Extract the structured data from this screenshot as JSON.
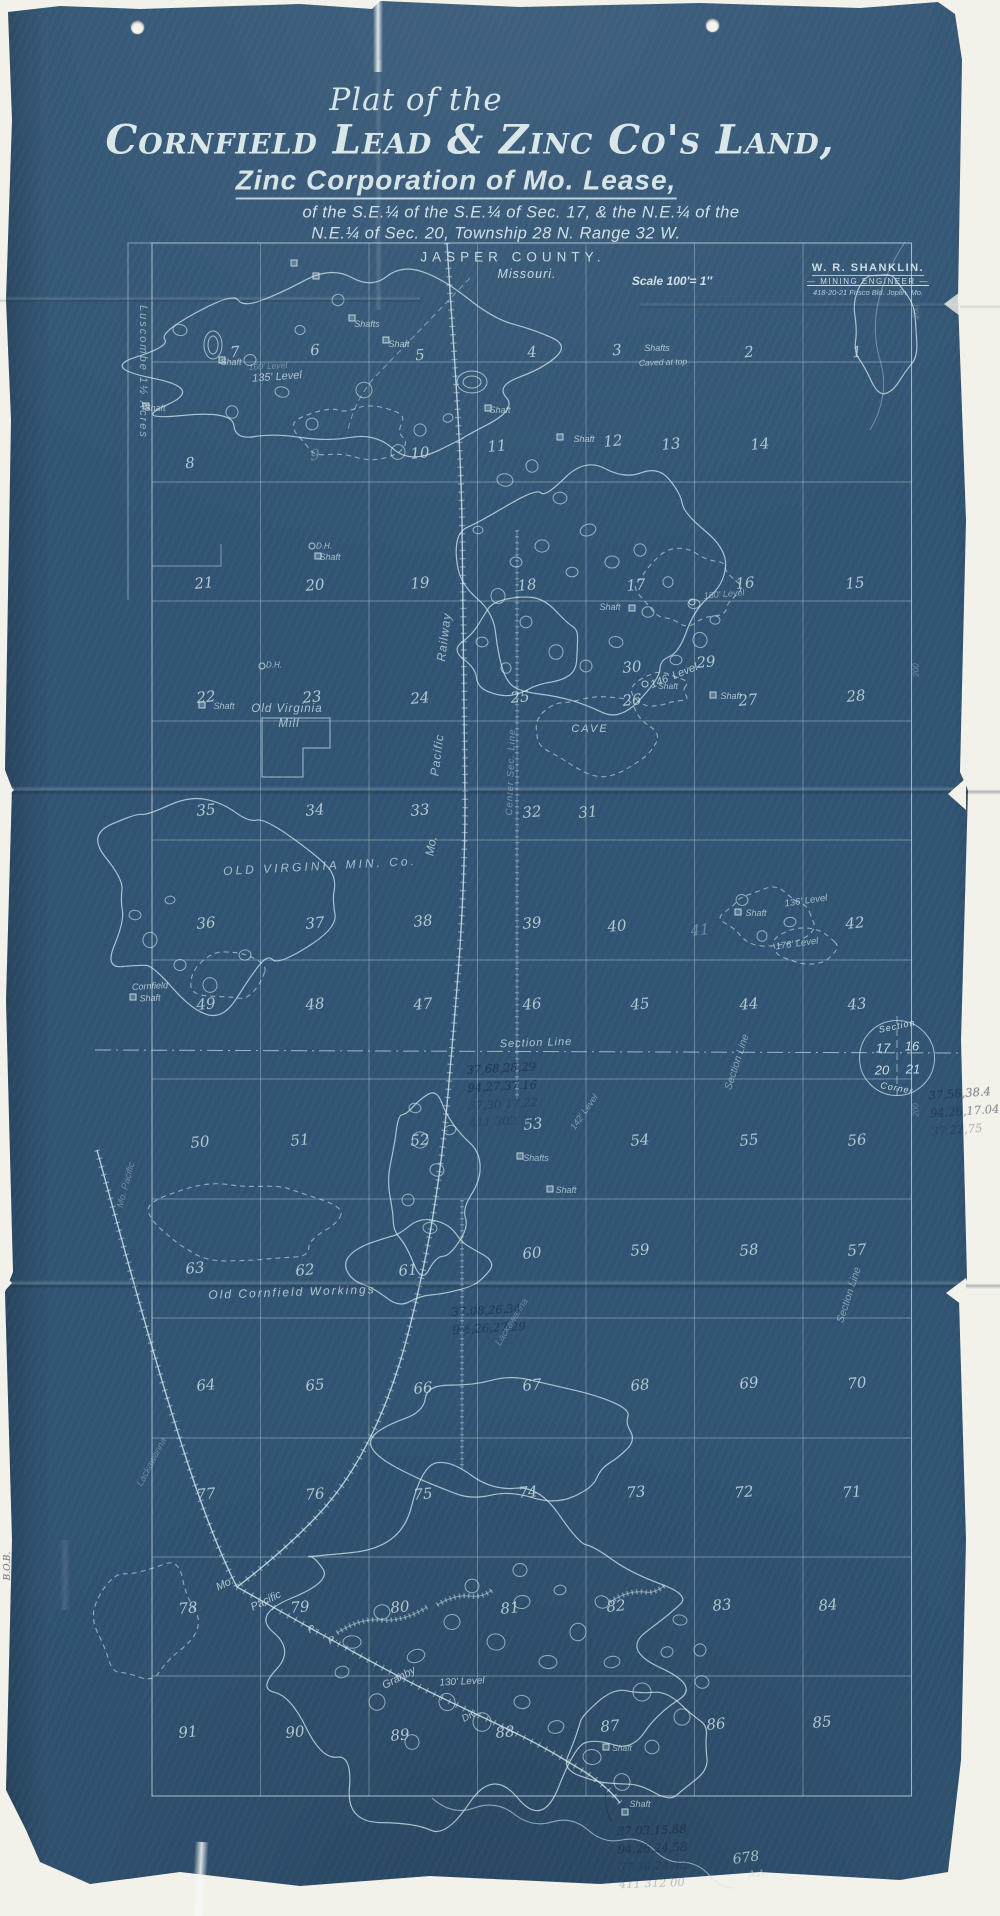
{
  "page": {
    "background": "#f2f1ea",
    "blueprint_color": "#315474",
    "ink_color": "#cfe0e4",
    "pencil_color": "#1d2a42"
  },
  "title": {
    "prefix": "Plat of the",
    "main": "Cornfield Lead & Zinc Co's Land,",
    "sub": "Zinc Corporation of Mo. Lease,",
    "desc1": "of the S.E.¼ of the S.E.¼ of Sec. 17, & the N.E.¼ of the",
    "desc2": "N.E.¼ of Sec. 20, Township 28 N. Range 32 W.",
    "county": "JASPER COUNTY.",
    "state": "Missouri.",
    "scale": "Scale 100'= 1″"
  },
  "stamp": {
    "name": "W. R. SHANKLIN.",
    "role": "— MINING ENGINEER —",
    "address": "418-20-21 Frisco Bld.   Joplin, Mo."
  },
  "section_corner": {
    "arc_top": "Section",
    "nw": "17",
    "ne": "16",
    "sw": "20",
    "se": "21",
    "arc_bottom": "Corner"
  },
  "corner_annotations": {
    "sheet_number": "678",
    "initials": "A.A.",
    "spine_mark": "B.O.B."
  },
  "map": {
    "plots": [
      {
        "n": "1",
        "x": 857,
        "y": 352
      },
      {
        "n": "2",
        "x": 749,
        "y": 352
      },
      {
        "n": "3",
        "x": 617,
        "y": 350
      },
      {
        "n": "4",
        "x": 532,
        "y": 352
      },
      {
        "n": "5",
        "x": 420,
        "y": 355
      },
      {
        "n": "6",
        "x": 315,
        "y": 350
      },
      {
        "n": "7",
        "x": 235,
        "y": 352
      },
      {
        "n": "8",
        "x": 190,
        "y": 463
      },
      {
        "n": "9",
        "x": 315,
        "y": 455,
        "f": 1
      },
      {
        "n": "10",
        "x": 420,
        "y": 453
      },
      {
        "n": "11",
        "x": 497,
        "y": 446
      },
      {
        "n": "12",
        "x": 613,
        "y": 441
      },
      {
        "n": "13",
        "x": 671,
        "y": 444
      },
      {
        "n": "14",
        "x": 760,
        "y": 444
      },
      {
        "n": "15",
        "x": 855,
        "y": 583
      },
      {
        "n": "16",
        "x": 745,
        "y": 583
      },
      {
        "n": "17",
        "x": 636,
        "y": 585
      },
      {
        "n": "18",
        "x": 527,
        "y": 585
      },
      {
        "n": "19",
        "x": 420,
        "y": 583
      },
      {
        "n": "20",
        "x": 315,
        "y": 585
      },
      {
        "n": "21",
        "x": 204,
        "y": 583
      },
      {
        "n": "22",
        "x": 206,
        "y": 697
      },
      {
        "n": "23",
        "x": 312,
        "y": 697
      },
      {
        "n": "24",
        "x": 420,
        "y": 698
      },
      {
        "n": "25",
        "x": 520,
        "y": 697
      },
      {
        "n": "26",
        "x": 632,
        "y": 700
      },
      {
        "n": "27",
        "x": 748,
        "y": 700
      },
      {
        "n": "28",
        "x": 856,
        "y": 696
      },
      {
        "n": "29",
        "x": 706,
        "y": 662
      },
      {
        "n": "30",
        "x": 632,
        "y": 667
      },
      {
        "n": "31",
        "x": 588,
        "y": 812
      },
      {
        "n": "32",
        "x": 532,
        "y": 812
      },
      {
        "n": "33",
        "x": 420,
        "y": 810
      },
      {
        "n": "34",
        "x": 315,
        "y": 810
      },
      {
        "n": "35",
        "x": 206,
        "y": 810
      },
      {
        "n": "36",
        "x": 206,
        "y": 923
      },
      {
        "n": "37",
        "x": 315,
        "y": 923
      },
      {
        "n": "38",
        "x": 423,
        "y": 921
      },
      {
        "n": "39",
        "x": 532,
        "y": 923
      },
      {
        "n": "40",
        "x": 617,
        "y": 926
      },
      {
        "n": "41",
        "x": 700,
        "y": 930,
        "f": 1
      },
      {
        "n": "42",
        "x": 855,
        "y": 923
      },
      {
        "n": "43",
        "x": 857,
        "y": 1004
      },
      {
        "n": "44",
        "x": 749,
        "y": 1004
      },
      {
        "n": "45",
        "x": 640,
        "y": 1004
      },
      {
        "n": "46",
        "x": 532,
        "y": 1004
      },
      {
        "n": "47",
        "x": 423,
        "y": 1004
      },
      {
        "n": "48",
        "x": 315,
        "y": 1004
      },
      {
        "n": "49",
        "x": 206,
        "y": 1004
      },
      {
        "n": "50",
        "x": 200,
        "y": 1142
      },
      {
        "n": "51",
        "x": 300,
        "y": 1140
      },
      {
        "n": "52",
        "x": 420,
        "y": 1140
      },
      {
        "n": "53",
        "x": 533,
        "y": 1124
      },
      {
        "n": "54",
        "x": 640,
        "y": 1140
      },
      {
        "n": "55",
        "x": 749,
        "y": 1140
      },
      {
        "n": "56",
        "x": 857,
        "y": 1140
      },
      {
        "n": "57",
        "x": 857,
        "y": 1250
      },
      {
        "n": "58",
        "x": 749,
        "y": 1250
      },
      {
        "n": "59",
        "x": 640,
        "y": 1250
      },
      {
        "n": "60",
        "x": 532,
        "y": 1253
      },
      {
        "n": "61",
        "x": 408,
        "y": 1270
      },
      {
        "n": "62",
        "x": 305,
        "y": 1270
      },
      {
        "n": "63",
        "x": 195,
        "y": 1268
      },
      {
        "n": "64",
        "x": 206,
        "y": 1385
      },
      {
        "n": "65",
        "x": 315,
        "y": 1385
      },
      {
        "n": "66",
        "x": 423,
        "y": 1388
      },
      {
        "n": "67",
        "x": 532,
        "y": 1385
      },
      {
        "n": "68",
        "x": 640,
        "y": 1385
      },
      {
        "n": "69",
        "x": 749,
        "y": 1383
      },
      {
        "n": "70",
        "x": 857,
        "y": 1383
      },
      {
        "n": "71",
        "x": 852,
        "y": 1492
      },
      {
        "n": "72",
        "x": 744,
        "y": 1492
      },
      {
        "n": "73",
        "x": 636,
        "y": 1492
      },
      {
        "n": "74",
        "x": 528,
        "y": 1492
      },
      {
        "n": "75",
        "x": 423,
        "y": 1494
      },
      {
        "n": "76",
        "x": 315,
        "y": 1494
      },
      {
        "n": "77",
        "x": 206,
        "y": 1494
      },
      {
        "n": "78",
        "x": 188,
        "y": 1608
      },
      {
        "n": "79",
        "x": 300,
        "y": 1607
      },
      {
        "n": "80",
        "x": 400,
        "y": 1607
      },
      {
        "n": "81",
        "x": 510,
        "y": 1608
      },
      {
        "n": "82",
        "x": 616,
        "y": 1606
      },
      {
        "n": "83",
        "x": 722,
        "y": 1605
      },
      {
        "n": "84",
        "x": 828,
        "y": 1605
      },
      {
        "n": "85",
        "x": 822,
        "y": 1722
      },
      {
        "n": "86",
        "x": 716,
        "y": 1724
      },
      {
        "n": "87",
        "x": 610,
        "y": 1726
      },
      {
        "n": "88",
        "x": 505,
        "y": 1732
      },
      {
        "n": "89",
        "x": 400,
        "y": 1735
      },
      {
        "n": "90",
        "x": 295,
        "y": 1732
      },
      {
        "n": "91",
        "x": 188,
        "y": 1732
      }
    ],
    "labels": [
      {
        "t": "Luscombe  1½ Acres",
        "x": 143,
        "y": 372,
        "r": 90,
        "s": 11,
        "o": 0.7,
        "ls": 2
      },
      {
        "t": "135' Level",
        "x": 277,
        "y": 377,
        "r": -4,
        "s": 11,
        "o": 0.85
      },
      {
        "t": "160' Level",
        "x": 268,
        "y": 366,
        "r": -3,
        "s": 8.5,
        "o": 0.45
      },
      {
        "t": "Shafts",
        "x": 367,
        "y": 324,
        "r": 0,
        "s": 9,
        "o": 0.85
      },
      {
        "t": "Shaft",
        "x": 399,
        "y": 344,
        "r": 0,
        "s": 9,
        "o": 0.85
      },
      {
        "t": "Shaft",
        "x": 231,
        "y": 362,
        "r": 0,
        "s": 9,
        "o": 0.8
      },
      {
        "t": "Shaft",
        "x": 155,
        "y": 408,
        "r": 0,
        "s": 9,
        "o": 0.8
      },
      {
        "t": "Shafts",
        "x": 657,
        "y": 348,
        "r": 0,
        "s": 9,
        "o": 0.85
      },
      {
        "t": "Caved at top",
        "x": 663,
        "y": 362,
        "r": -2,
        "s": 8.5,
        "o": 0.8
      },
      {
        "t": "Shaft",
        "x": 500,
        "y": 410,
        "r": 0,
        "s": 9,
        "o": 0.8
      },
      {
        "t": "Shaft",
        "x": 584,
        "y": 439,
        "r": 0,
        "s": 9,
        "o": 0.85
      },
      {
        "t": "D.H.",
        "x": 324,
        "y": 546,
        "r": 0,
        "s": 8,
        "o": 0.8
      },
      {
        "t": "Shaft",
        "x": 330,
        "y": 557,
        "r": 0,
        "s": 9,
        "o": 0.8
      },
      {
        "t": "D.H.",
        "x": 274,
        "y": 665,
        "r": 0,
        "s": 8,
        "o": 0.8
      },
      {
        "t": "Shaft",
        "x": 224,
        "y": 706,
        "r": 0,
        "s": 9,
        "o": 0.8
      },
      {
        "t": "Old Virginia",
        "x": 287,
        "y": 709,
        "r": 0,
        "s": 11.5,
        "o": 0.85,
        "ls": 1
      },
      {
        "t": "Mill",
        "x": 289,
        "y": 724,
        "r": 0,
        "s": 11.5,
        "o": 0.85,
        "ls": 1
      },
      {
        "t": "Railway",
        "x": 444,
        "y": 637,
        "r": -83,
        "s": 12,
        "o": 0.8,
        "ls": 1
      },
      {
        "t": "Pacific",
        "x": 437,
        "y": 755,
        "r": -83,
        "s": 12,
        "o": 0.8,
        "ls": 1
      },
      {
        "t": "Mo.",
        "x": 431,
        "y": 846,
        "r": -80,
        "s": 12,
        "o": 0.8
      },
      {
        "t": "Center Sec. Line",
        "x": 511,
        "y": 772,
        "r": -88,
        "s": 9.5,
        "o": 0.5,
        "ls": 1
      },
      {
        "t": "OLD VIRGINIA MIN. Co.",
        "x": 320,
        "y": 866,
        "r": -3,
        "s": 12,
        "o": 0.8,
        "ls": 3
      },
      {
        "t": "146' Level",
        "x": 674,
        "y": 676,
        "r": -22,
        "s": 11,
        "o": 0.85
      },
      {
        "t": "Shaft",
        "x": 610,
        "y": 607,
        "r": 0,
        "s": 9,
        "o": 0.8
      },
      {
        "t": "Shaft",
        "x": 668,
        "y": 686,
        "r": 0,
        "s": 8.5,
        "o": 0.8
      },
      {
        "t": "Shaft",
        "x": 731,
        "y": 696,
        "r": 0,
        "s": 9,
        "o": 0.85
      },
      {
        "t": "180' Level",
        "x": 724,
        "y": 594,
        "r": -5,
        "s": 9,
        "o": 0.6
      },
      {
        "t": "CAVE",
        "x": 590,
        "y": 729,
        "r": 0,
        "s": 11,
        "o": 0.85,
        "ls": 2
      },
      {
        "t": "136' Level",
        "x": 806,
        "y": 901,
        "r": -8,
        "s": 9.5,
        "o": 0.8
      },
      {
        "t": "176' Level",
        "x": 797,
        "y": 944,
        "r": -8,
        "s": 9.5,
        "o": 0.8
      },
      {
        "t": "Shaft",
        "x": 756,
        "y": 913,
        "r": 0,
        "s": 9,
        "o": 0.8
      },
      {
        "t": "Section Line",
        "x": 536,
        "y": 1043,
        "r": -2,
        "s": 11,
        "o": 0.85,
        "ls": 1
      },
      {
        "t": "Section Line",
        "x": 737,
        "y": 1062,
        "r": -72,
        "s": 10.5,
        "o": 0.6
      },
      {
        "t": "Section Line",
        "x": 849,
        "y": 1295,
        "r": -72,
        "s": 10.5,
        "o": 0.6
      },
      {
        "t": "Cornfield",
        "x": 150,
        "y": 986,
        "r": -3,
        "s": 9,
        "o": 0.85
      },
      {
        "t": "Shaft",
        "x": 150,
        "y": 998,
        "r": -3,
        "s": 9,
        "o": 0.85
      },
      {
        "t": "Old Cornfield Workings",
        "x": 292,
        "y": 1292,
        "r": -2,
        "s": 12,
        "o": 0.85,
        "ls": 2
      },
      {
        "t": "142' Level",
        "x": 584,
        "y": 1112,
        "r": -55,
        "s": 9,
        "o": 0.55
      },
      {
        "t": "Shafts",
        "x": 536,
        "y": 1158,
        "r": 0,
        "s": 9,
        "o": 0.8
      },
      {
        "t": "Shaft",
        "x": 566,
        "y": 1190,
        "r": 0,
        "s": 9,
        "o": 0.8
      },
      {
        "t": "Mo. Pacific",
        "x": 126,
        "y": 1185,
        "r": -75,
        "s": 9.5,
        "o": 0.4
      },
      {
        "t": "Lackawanna",
        "x": 512,
        "y": 1322,
        "r": -58,
        "s": 9.5,
        "o": 0.38
      },
      {
        "t": "Lackawanna",
        "x": 152,
        "y": 1462,
        "r": -62,
        "s": 9.5,
        "o": 0.38
      },
      {
        "t": "Mo.",
        "x": 225,
        "y": 1584,
        "r": -26,
        "s": 11,
        "o": 0.85
      },
      {
        "t": "Pacific",
        "x": 266,
        "y": 1601,
        "r": -26,
        "s": 11,
        "o": 0.85
      },
      {
        "t": "R.",
        "x": 313,
        "y": 1629,
        "r": -26,
        "s": 10,
        "o": 0.8
      },
      {
        "t": "R.",
        "x": 333,
        "y": 1640,
        "r": -26,
        "s": 10,
        "o": 0.8
      },
      {
        "t": "Granby",
        "x": 399,
        "y": 1678,
        "r": -28,
        "s": 11,
        "o": 0.85
      },
      {
        "t": "Div.",
        "x": 470,
        "y": 1716,
        "r": -28,
        "s": 10,
        "o": 0.8
      },
      {
        "t": "130' Level",
        "x": 462,
        "y": 1682,
        "r": -3,
        "s": 10,
        "o": 0.85
      },
      {
        "t": "Shaft",
        "x": 640,
        "y": 1804,
        "r": 0,
        "s": 9,
        "o": 0.8
      },
      {
        "t": "Shaft",
        "x": 622,
        "y": 1748,
        "r": 0,
        "s": 8.5,
        "o": 0.75
      },
      {
        "t": "200",
        "x": 916,
        "y": 312,
        "r": -90,
        "s": 8,
        "o": 0.4
      },
      {
        "t": "200",
        "x": 916,
        "y": 670,
        "r": -90,
        "s": 8,
        "o": 0.4
      },
      {
        "t": "200",
        "x": 916,
        "y": 1110,
        "r": -90,
        "s": 8,
        "o": 0.35
      }
    ],
    "markers": [
      {
        "k": "sq",
        "x": 294,
        "y": 263
      },
      {
        "k": "sq",
        "x": 316,
        "y": 276
      },
      {
        "k": "sq",
        "x": 352,
        "y": 318
      },
      {
        "k": "sq",
        "x": 386,
        "y": 340
      },
      {
        "k": "sq",
        "x": 222,
        "y": 360
      },
      {
        "k": "sq",
        "x": 146,
        "y": 406
      },
      {
        "k": "sq",
        "x": 560,
        "y": 437
      },
      {
        "k": "sq",
        "x": 488,
        "y": 408
      },
      {
        "k": "sq",
        "x": 318,
        "y": 556
      },
      {
        "k": "sq",
        "x": 202,
        "y": 705
      },
      {
        "k": "sq",
        "x": 632,
        "y": 608
      },
      {
        "k": "sq",
        "x": 713,
        "y": 695
      },
      {
        "k": "sq",
        "x": 738,
        "y": 912
      },
      {
        "k": "sq",
        "x": 520,
        "y": 1156
      },
      {
        "k": "sq",
        "x": 550,
        "y": 1189
      },
      {
        "k": "sq",
        "x": 606,
        "y": 1747
      },
      {
        "k": "sq",
        "x": 625,
        "y": 1812
      },
      {
        "k": "sq",
        "x": 133,
        "y": 997
      },
      {
        "k": "ci",
        "x": 312,
        "y": 546
      },
      {
        "k": "ci",
        "x": 262,
        "y": 666
      },
      {
        "k": "ci",
        "x": 645,
        "y": 684
      },
      {
        "k": "ci",
        "x": 692,
        "y": 602
      }
    ],
    "pencil_notes": [
      {
        "x": 468,
        "y": 1060,
        "r": -3,
        "lines": [
          {
            "t": "37,68,28,29",
            "o": 0.65
          },
          {
            "t": "94,27,37.16",
            "o": 0.6
          },
          {
            "t": "37,30 17.22",
            "o": 0.32
          },
          {
            "t": "411  302.00",
            "o": 0.28
          }
        ]
      },
      {
        "x": 930,
        "y": 1085,
        "r": -4,
        "lines": [
          {
            "t": "37,58,38.4",
            "o": 0.55
          },
          {
            "t": "94,26,17.04",
            "o": 0.5
          },
          {
            "t": "37,22,75",
            "o": 0.3
          }
        ]
      },
      {
        "x": 452,
        "y": 1302,
        "r": -3,
        "lines": [
          {
            "t": "37,08,26.34",
            "o": 0.6
          },
          {
            "t": "9½,26,27,29",
            "o": 0.55
          }
        ]
      },
      {
        "x": 618,
        "y": 1822,
        "r": -2,
        "lines": [
          {
            "t": "37,03,15.88",
            "o": 0.6
          },
          {
            "t": "94,26,24,58",
            "o": 0.55
          },
          {
            "t": "37,36,24.42",
            "o": 0.28
          },
          {
            "t": "411  312  00",
            "o": 0.24
          }
        ]
      }
    ]
  }
}
